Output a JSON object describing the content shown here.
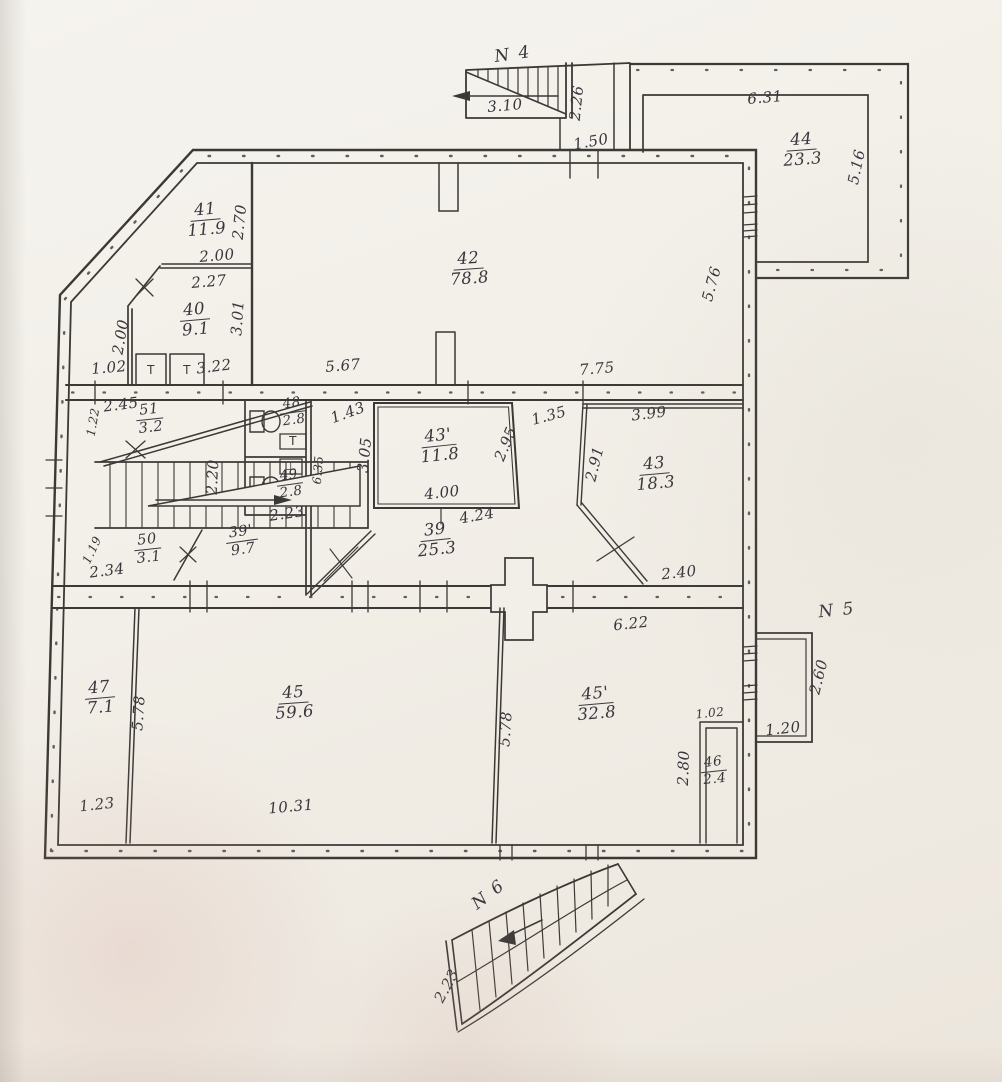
{
  "colors": {
    "ink": "#3b3936",
    "paper": "#f2efe8"
  },
  "stairs": [
    {
      "label": "N 4"
    },
    {
      "label": "N 5"
    },
    {
      "label": "N 6"
    }
  ],
  "rooms": [
    {
      "num": "41",
      "area": "11.9"
    },
    {
      "num": "40",
      "area": "9.1"
    },
    {
      "num": "42",
      "area": "78.8"
    },
    {
      "num": "44",
      "area": "23.3"
    },
    {
      "num": "51",
      "area": "3.2"
    },
    {
      "num": "48",
      "area": "2.8"
    },
    {
      "num": "49",
      "area": "2.8"
    },
    {
      "num": "43'",
      "area": "11.8"
    },
    {
      "num": "43",
      "area": "18.3"
    },
    {
      "num": "50",
      "area": "3.1"
    },
    {
      "num": "39'",
      "area": "9.7"
    },
    {
      "num": "39",
      "area": "25.3"
    },
    {
      "num": "47",
      "area": "7.1"
    },
    {
      "num": "45",
      "area": "59.6"
    },
    {
      "num": "45'",
      "area": "32.8"
    },
    {
      "num": "46",
      "area": "2.4"
    }
  ],
  "dims": [
    "3.10",
    "2.26",
    "1.50",
    "6.31",
    "5.16",
    "5.76",
    "2.70",
    "2.00",
    "2.27",
    "3.01",
    "2.00",
    "1.02",
    "3.22",
    "5.67",
    "7.75",
    "2.45",
    "1.22",
    "1.43",
    "3.05",
    "2.95",
    "1.35",
    "3.99",
    "2.91",
    "4.00",
    "4.24",
    "2.23",
    "6.35",
    "2.20",
    "1.19",
    "2.34",
    "2.40",
    "6.22",
    "2.60",
    "1.20",
    "5.78",
    "5.78",
    "1.02",
    "2.80",
    "1.23",
    "10.31",
    "2.23"
  ],
  "vents": [
    "T",
    "T",
    "T",
    "⊥"
  ]
}
